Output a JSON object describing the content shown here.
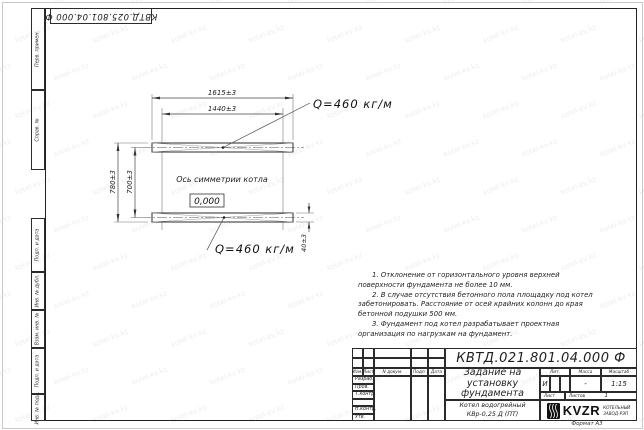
{
  "sheet": {
    "top_designation": "КВТД.025.801.04.000 Ф",
    "format_label": "Формат А3",
    "side_labels": [
      "Перв. примен.",
      "Справ. №",
      "Подп. и дата",
      "Инв. № дубл.",
      "Взам. инв. №",
      "Подп. и дата",
      "Инв. № подл."
    ]
  },
  "watermark": {
    "text": "kotel-kv.kz"
  },
  "drawing": {
    "dim_top_outer": "1615±3",
    "dim_top_inner": "1440±3",
    "dim_left_outer": "780±3",
    "dim_left_inner": "700±3",
    "dim_right": "40±3",
    "load_label_top": "Q=460 кг/м",
    "load_label_bottom": "Q=460 кг/м",
    "axis_label": "Ось симметрии котла",
    "level_mark": "0,000"
  },
  "notes": [
    "1. Отклонение от горизонтального уровня верхней поверхности фундамента не более 10 мм.",
    "2. В случае отсутствия бетонного пола площадку под котел забетонировать. Расстояние от осей крайних колонн до края бетонной подушки 500 мм.",
    "3. Фундамент под котел разрабатывает проектная организация по нагрузкам на фундамент."
  ],
  "title_block": {
    "designation": "КВТД.021.801.04.000 Ф",
    "title": "Задание на установку фундамента",
    "product": "Котел водогрейный КВр-0,25 Д (ПТ)",
    "columns": {
      "izm": "Изм.",
      "list": "Лист",
      "doc": "N докум.",
      "podp": "Подп.",
      "data": "Дата"
    },
    "rows": [
      "Разраб.",
      "Пров.",
      "Т.контр.",
      "",
      "Н.контр.",
      "Утв."
    ],
    "lit_label": "Лит.",
    "lit_value": "И",
    "mass_label": "Масса",
    "mass_value": "-",
    "scale_label": "Масштаб",
    "scale_value": "1:15",
    "sheet_label": "Лист",
    "sheets_label": "Листов",
    "sheets_value": "1",
    "logo_text": "KVZR",
    "logo_sub1": "КОТЕЛЬНЫЙ",
    "logo_sub2": "ЗАВОД-РЭП"
  }
}
